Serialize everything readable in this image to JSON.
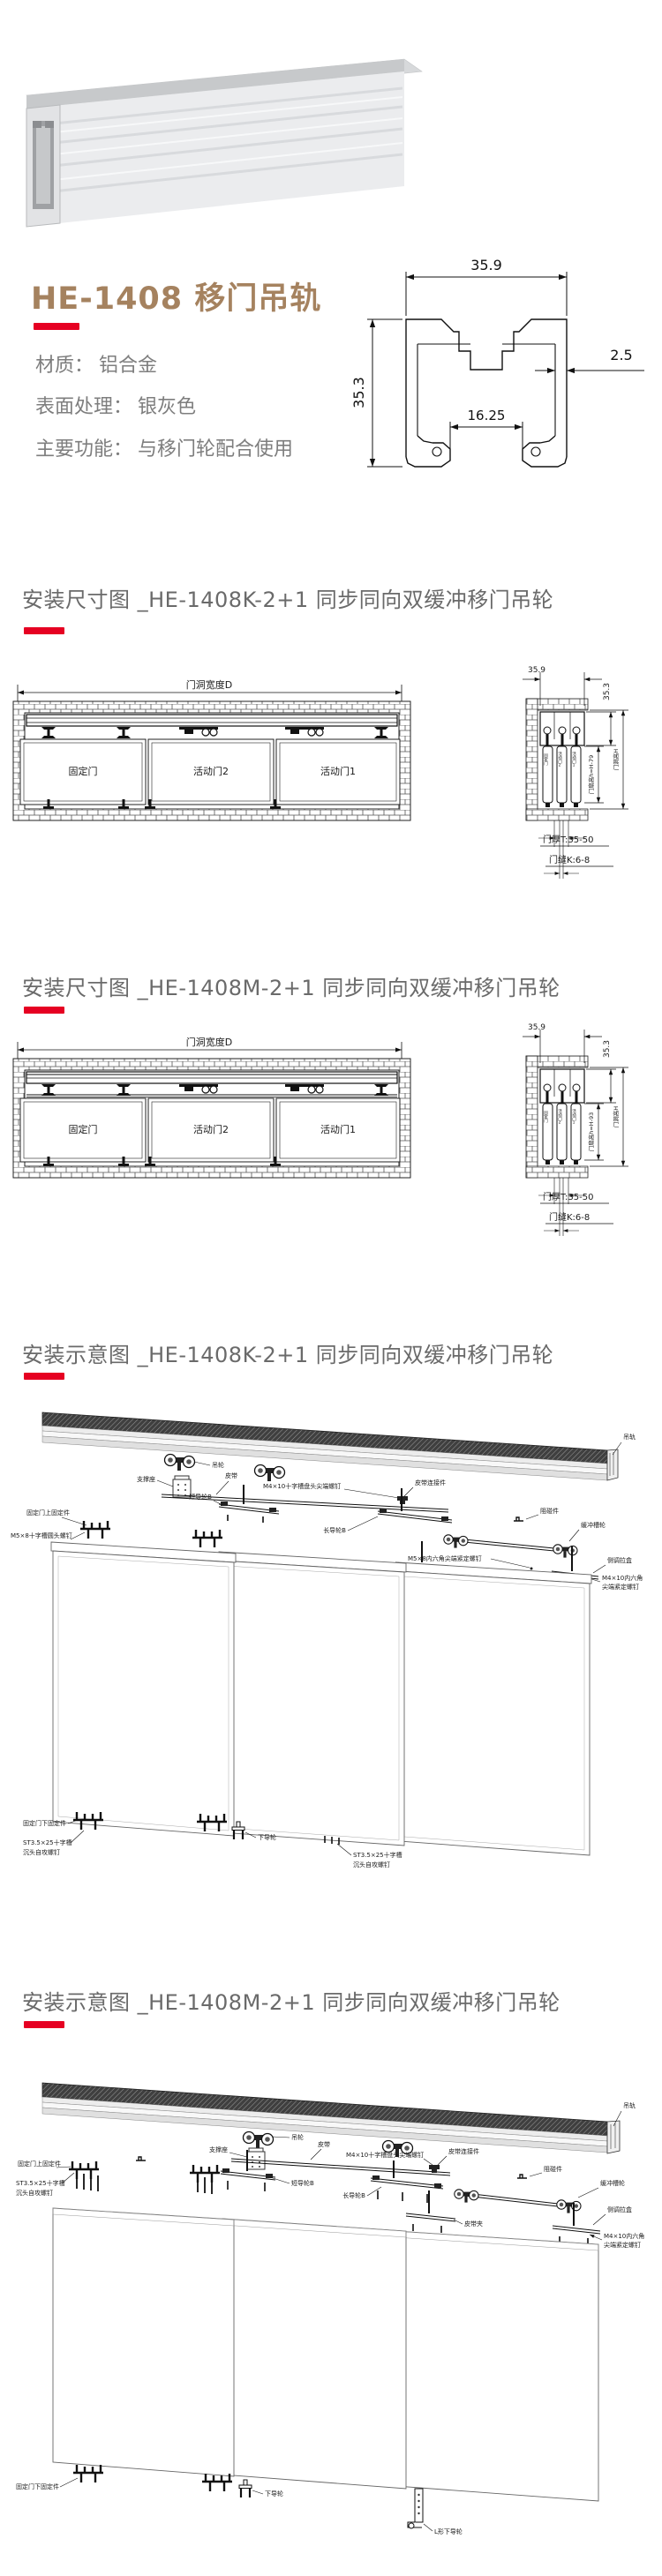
{
  "colors": {
    "accent_red": "#e60022",
    "title_brown": "#a5825f",
    "spec_gray": "#7e7e7e",
    "heading_gray": "#6a6a6a",
    "line_black": "#1a1a1a"
  },
  "product": {
    "title": "HE-1408 移门吊轨",
    "specs": [
      {
        "label": "材质：",
        "value": "铝合金"
      },
      {
        "label": "表面处理：",
        "value": "银灰色"
      },
      {
        "label": "主要功能：",
        "value": "与移门轮配合使用"
      }
    ]
  },
  "cross_section": {
    "dim_width": "35.9",
    "dim_height": "35.3",
    "dim_wall": "2.5",
    "dim_slot": "16.25"
  },
  "sections": {
    "dim_k": "安装尺寸图 _HE-1408K-2+1 同步同向双缓冲移门吊轮",
    "dim_m": "安装尺寸图 _HE-1408M-2+1 同步同向双缓冲移门吊轮",
    "exp_k": "安装示意图 _HE-1408K-2+1 同步同向双缓冲移门吊轮",
    "exp_m": "安装示意图 _HE-1408M-2+1 同步同向双缓冲移门吊轮"
  },
  "dim_drawing": {
    "opening_width": "门洞宽度D",
    "door_fixed": "固定门",
    "door_move2": "活动门2",
    "door_move1": "活动门1",
    "track_w": "35.9",
    "track_h": "35.3",
    "leaf_height_k": "门扇高h=H-79",
    "leaf_height_m": "门扇高h=H-93",
    "opening_height": "门洞高H",
    "thickness": "门厚T:35-50",
    "gap": "门缝K:6-8"
  },
  "exploded": {
    "track": "吊轨",
    "wheel": "吊轮",
    "support": "支撑座",
    "belt": "皮带",
    "screw_pan": "M4×10十字槽盘头尖端螺钉",
    "belt_conn": "皮带连接件",
    "guide_short": "短导轮B",
    "top_fix": "固定门上固定件",
    "screw_round": "M5×8十字槽圆头螺钉",
    "guide_long": "长导轮B",
    "stopper": "阻碰件",
    "buffer_wheel": "缓冲槽轮",
    "screw_set_m5": "M5×8内六角尖端紧定螺钉",
    "belt_clip": "皮带夹",
    "fixer": "固定件",
    "side_box": "侧调拉盒",
    "screw_set_m4a": "M4×10内六角",
    "screw_set_m4b": "尖端紧定螺钉",
    "bottom_fix": "固定门下固定件",
    "screw_st_a": "ST3.5×25十字槽",
    "screw_st_b": "沉头自攻螺钉",
    "guide_bottom": "下导轮",
    "guide_bottom_l": "L形下导轮"
  }
}
